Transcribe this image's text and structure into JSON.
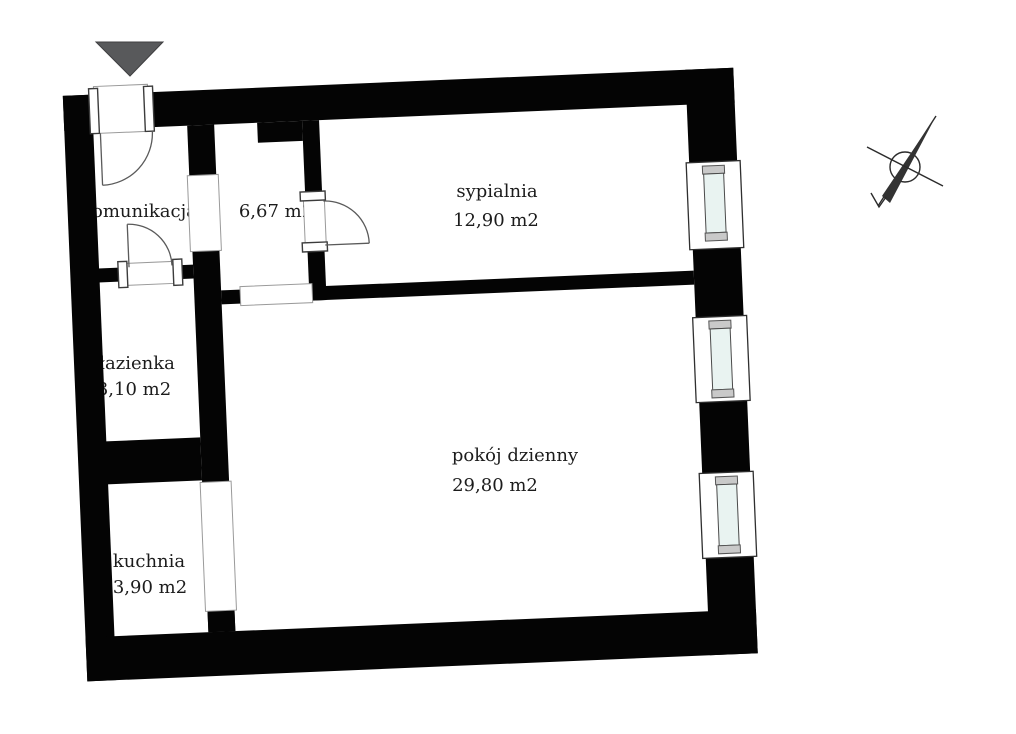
{
  "plan": {
    "rooms": [
      {
        "name": "komunikacja",
        "area": "6,67 m2"
      },
      {
        "name": "sypialnia",
        "area": "12,90 m2"
      },
      {
        "name": "łazienka",
        "area": "3,10 m2"
      },
      {
        "name": "pokój dzienny",
        "area": "29,80 m2"
      },
      {
        "name": "kuchnia",
        "area": "3,90 m2"
      }
    ],
    "symbols": {
      "entry_marker": "entry-arrow-icon",
      "north_marker": "north-compass-icon"
    },
    "counts": {
      "windows": 3,
      "doors": 3,
      "wall_openings": 3
    },
    "colors": {
      "wall": "#040404",
      "background": "#ffffff",
      "window_pane": "#e9f3f1",
      "window_cap": "#c9c9c9",
      "entry_arrow": "#58595b"
    }
  }
}
